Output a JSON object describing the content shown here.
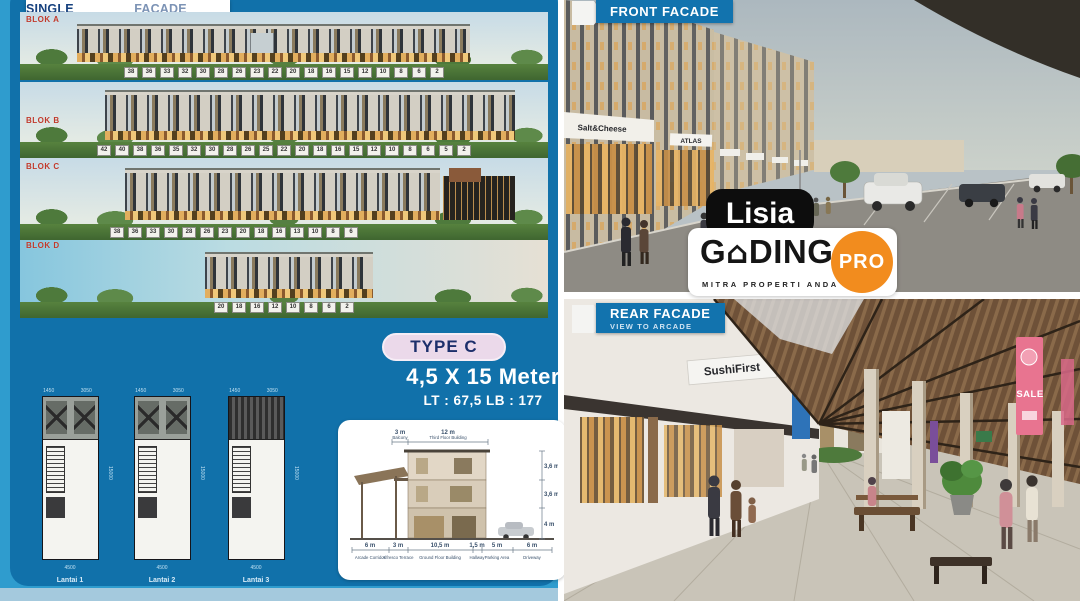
{
  "branding": {
    "watermark": "Lisia",
    "logo": {
      "g": "G",
      "house_icon": "⌂",
      "ding": "DING",
      "pro": "PRO",
      "tagline": "MITRA PROPERTI ANDA"
    },
    "colors": {
      "panel_blue": "#1171AA",
      "outer_blue": "#2F9CCE",
      "banner_blue": "#1273AE",
      "orange": "#F28C1E",
      "blok_red": "#C0392B",
      "pill_pink": "#EBD9EA",
      "navy": "#1C2F6B"
    }
  },
  "left_panel": {
    "title_bold": "SINGLE BALCONY",
    "title_light": "FACADE DESIGN",
    "blocks": [
      {
        "label": "BLOK A",
        "units": [
          "38",
          "36",
          "33",
          "32",
          "30",
          "28",
          "26",
          "23",
          "22",
          "20",
          "18",
          "16",
          "15",
          "12",
          "10",
          "8",
          "6",
          "2"
        ]
      },
      {
        "label": "BLOK B",
        "units": [
          "42",
          "40",
          "38",
          "36",
          "35",
          "32",
          "30",
          "28",
          "26",
          "25",
          "22",
          "20",
          "18",
          "16",
          "15",
          "12",
          "10",
          "8",
          "6",
          "5",
          "2"
        ]
      },
      {
        "label": "BLOK C",
        "units": [
          "38",
          "36",
          "33",
          "30",
          "28",
          "26",
          "23",
          "20",
          "18",
          "16",
          "13",
          "10",
          "8",
          "6"
        ]
      },
      {
        "label": "BLOK D",
        "units": [
          "20",
          "18",
          "16",
          "12",
          "10",
          "8",
          "6",
          "2"
        ]
      }
    ],
    "type_box": {
      "label": "TYPE C",
      "size": "4,5 X 15 Meter",
      "area": "LT : 67,5  LB : 177"
    },
    "floor_plans": [
      {
        "label": "Lantai 1",
        "dim_top_left": "1450",
        "dim_top_right": "3050",
        "dim_bottom": "4500",
        "dim_side": "15000"
      },
      {
        "label": "Lantai 2",
        "dim_top_left": "1450",
        "dim_top_right": "3050",
        "dim_bottom": "4500",
        "dim_side": "15000"
      },
      {
        "label": "Lantai 3",
        "dim_top_left": "1450",
        "dim_top_right": "3050",
        "dim_bottom": "4500",
        "dim_side": "15000"
      }
    ],
    "section": {
      "top": [
        {
          "value": "3 m",
          "label": "Balcony"
        },
        {
          "value": "12 m",
          "label": "Third Floor Building"
        }
      ],
      "right": [
        "3,6 m",
        "3,6 m",
        "4 m"
      ],
      "bottom": [
        {
          "value": "6 m",
          "label": "Arcade Corridor"
        },
        {
          "value": "3 m",
          "label": "Alfresco Terrace"
        },
        {
          "value": "10,5 m",
          "label": "Ground Floor Building"
        },
        {
          "value": "1,5 m",
          "label": "Hallway"
        },
        {
          "value": "5 m",
          "label": "Parking Area"
        },
        {
          "value": "6 m",
          "label": "Driveway"
        }
      ]
    }
  },
  "right_panel": {
    "front": {
      "banner": "FRONT FACADE",
      "sign_1": "Salt&Cheese",
      "sign_2": "ATLAS"
    },
    "rear": {
      "banner_title": "REAR FACADE",
      "banner_subtitle": "VIEW TO ARCADE",
      "sign_1": "SushiFirst",
      "sign_2": "SALE"
    }
  }
}
